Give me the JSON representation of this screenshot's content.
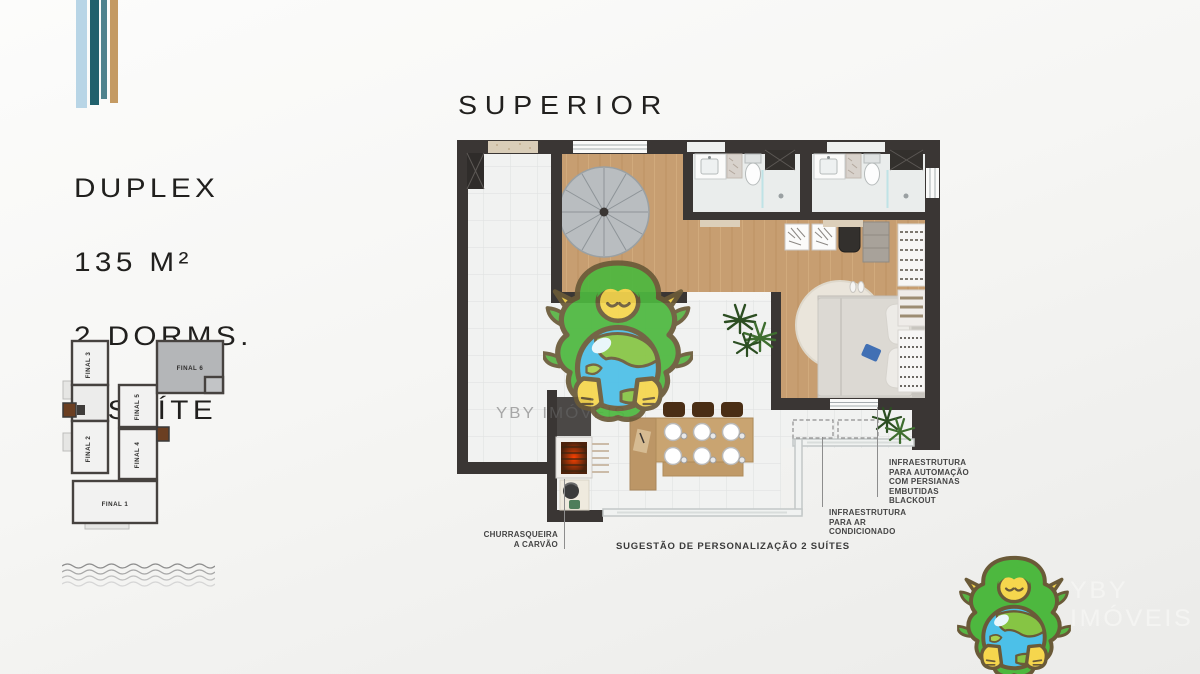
{
  "brand": {
    "stripe_colors": [
      "#b8d5e6",
      "#20606c",
      "#4f828d",
      "#c49a63"
    ],
    "watermark_text": "YBY IMÓVEIS",
    "logo_text": "YBY IMÓVEIS"
  },
  "listing": {
    "line1": "DUPLEX",
    "line2": "135 M²",
    "line3": "2 DORMS.",
    "line4": "1 SUÍTE"
  },
  "plan": {
    "title": "SUPERIOR",
    "caption": "SUGESTÃO DE PERSONALIZAÇÃO  2 SUÍTES",
    "annotations": {
      "churrasqueira": "CHURRASQUEIRA\nA CARVÃO",
      "automation": "INFRAESTRUTURA\nPARA AUTOMAÇÃO\nCOM PERSIANAS\nEMBUTIDAS\nBLACKOUT",
      "air_conditioning": "INFRAESTRUTURA\nPARA AR\nCONDICIONADO"
    }
  },
  "key_plan": {
    "highlighted_unit": "FINAL 6",
    "units": [
      {
        "label": "FINAL 3"
      },
      {
        "label": "FINAL 2"
      },
      {
        "label": "FINAL 5"
      },
      {
        "label": "FINAL 4"
      },
      {
        "label": "FINAL 1"
      },
      {
        "label": "FINAL 6"
      }
    ]
  },
  "colors": {
    "wall": "#3a3634",
    "wood_floor": "#c79e71",
    "tile_floor": "#f1f2f1",
    "accent_ember": "#d03a10"
  }
}
